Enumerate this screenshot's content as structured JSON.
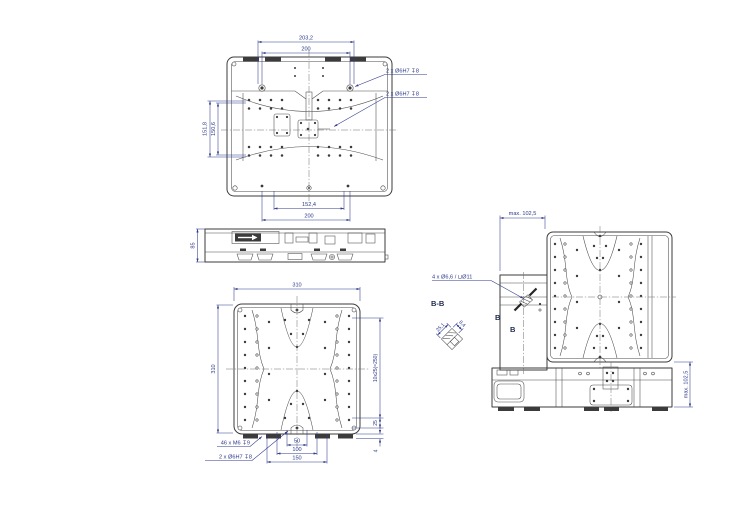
{
  "colors": {
    "line": "#3b3b3b",
    "dimension": "#2e3a8c"
  },
  "top_view": {
    "dim_width_outer": "203,2",
    "dim_width_pitch": "200",
    "dim_height_outer": "151,8",
    "dim_height_pitch": "150,6",
    "dim_bottom_pitch": "152,4",
    "dim_bottom_width": "200",
    "label_dowel_top": "2 x Ø6H7 ↧8",
    "label_dowel_center": "2 x Ø6H7 ↧8"
  },
  "side_view": {
    "dim_height": "85"
  },
  "bottom_view": {
    "dim_width": "310",
    "dim_height": "310",
    "dim_hole_pitch": "10x25(=250)",
    "dim_edge": "25",
    "dim_foot_height": "4",
    "dim_pitch_50": "50",
    "dim_pitch_100": "100",
    "dim_pitch_150": "150",
    "label_thread_holes": "46 x M6 ↧9",
    "label_dowel_holes": "2 x Ø6H7 ↧8"
  },
  "section_view": {
    "title": "B-B",
    "dim_width": "25,1",
    "dim_depth": "8,4"
  },
  "front_view": {
    "dim_travel_horizontal": "max. 102,5",
    "dim_travel_vertical": "max. 102,5",
    "label_mount_holes": "4 x Ø6,6 / ⊔Ø11",
    "marker_b1": "B",
    "marker_b2": "B"
  }
}
